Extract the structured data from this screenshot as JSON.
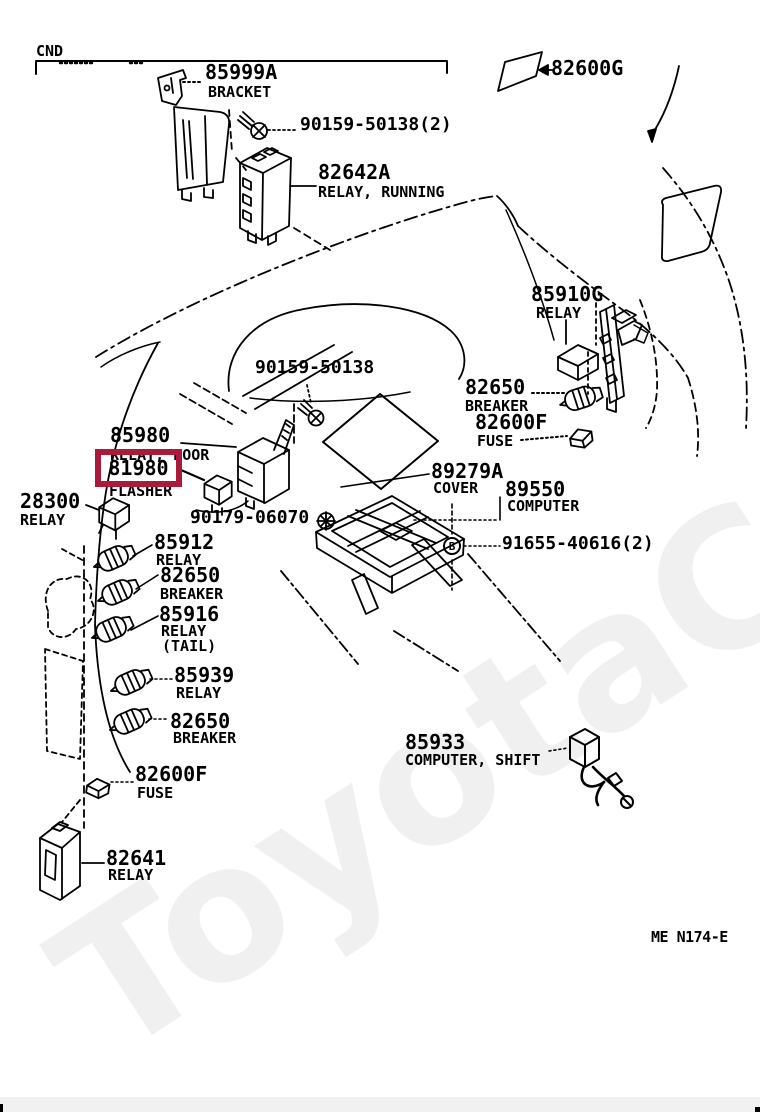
{
  "page": {
    "cnd": "CND",
    "sheet_code": "ME N174-E",
    "watermark": "ToyotaC"
  },
  "colors": {
    "highlight_red": "#ab1a3c",
    "line_black": "#000000",
    "watermark_gray": "#f0f0f0",
    "footer_gray": "#f1f1f1"
  },
  "parts": {
    "p85999a": {
      "num": "85999A",
      "desc": "BRACKET"
    },
    "p90159x2": {
      "num": "90159-50138(2)"
    },
    "p82642a": {
      "num": "82642A",
      "desc": "RELAY, RUNNING"
    },
    "p82600g": {
      "num": "82600G"
    },
    "p85910g": {
      "num": "85910G",
      "desc": "RELAY"
    },
    "p90159": {
      "num": "90159-50138"
    },
    "p82650r": {
      "num": "82650",
      "desc": "BREAKER"
    },
    "p82600fr": {
      "num": "82600F",
      "desc": "FUSE"
    },
    "p85980": {
      "num": "85980",
      "desc": "RELAY, DOOR"
    },
    "p81980": {
      "num": "81980",
      "desc": "FLASHER"
    },
    "p28300": {
      "num": "28300",
      "desc": "RELAY"
    },
    "p90179": {
      "num": "90179-06070"
    },
    "p89279a": {
      "num": "89279A",
      "desc": "COVER"
    },
    "p89550": {
      "num": "89550",
      "desc": "COMPUTER"
    },
    "p91655": {
      "num": "91655-40616(2)",
      "marker": "B"
    },
    "p85912": {
      "num": "85912",
      "desc": "RELAY"
    },
    "p82650m": {
      "num": "82650",
      "desc": "BREAKER"
    },
    "p85916": {
      "num": "85916",
      "desc": "RELAY",
      "desc2": "(TAIL)"
    },
    "p85939": {
      "num": "85939",
      "desc": "RELAY"
    },
    "p82650b": {
      "num": "82650",
      "desc": "BREAKER"
    },
    "p82600fb": {
      "num": "82600F",
      "desc": "FUSE"
    },
    "p82641": {
      "num": "82641",
      "desc": "RELAY"
    },
    "p85933": {
      "num": "85933",
      "desc": "COMPUTER, SHIFT"
    }
  }
}
